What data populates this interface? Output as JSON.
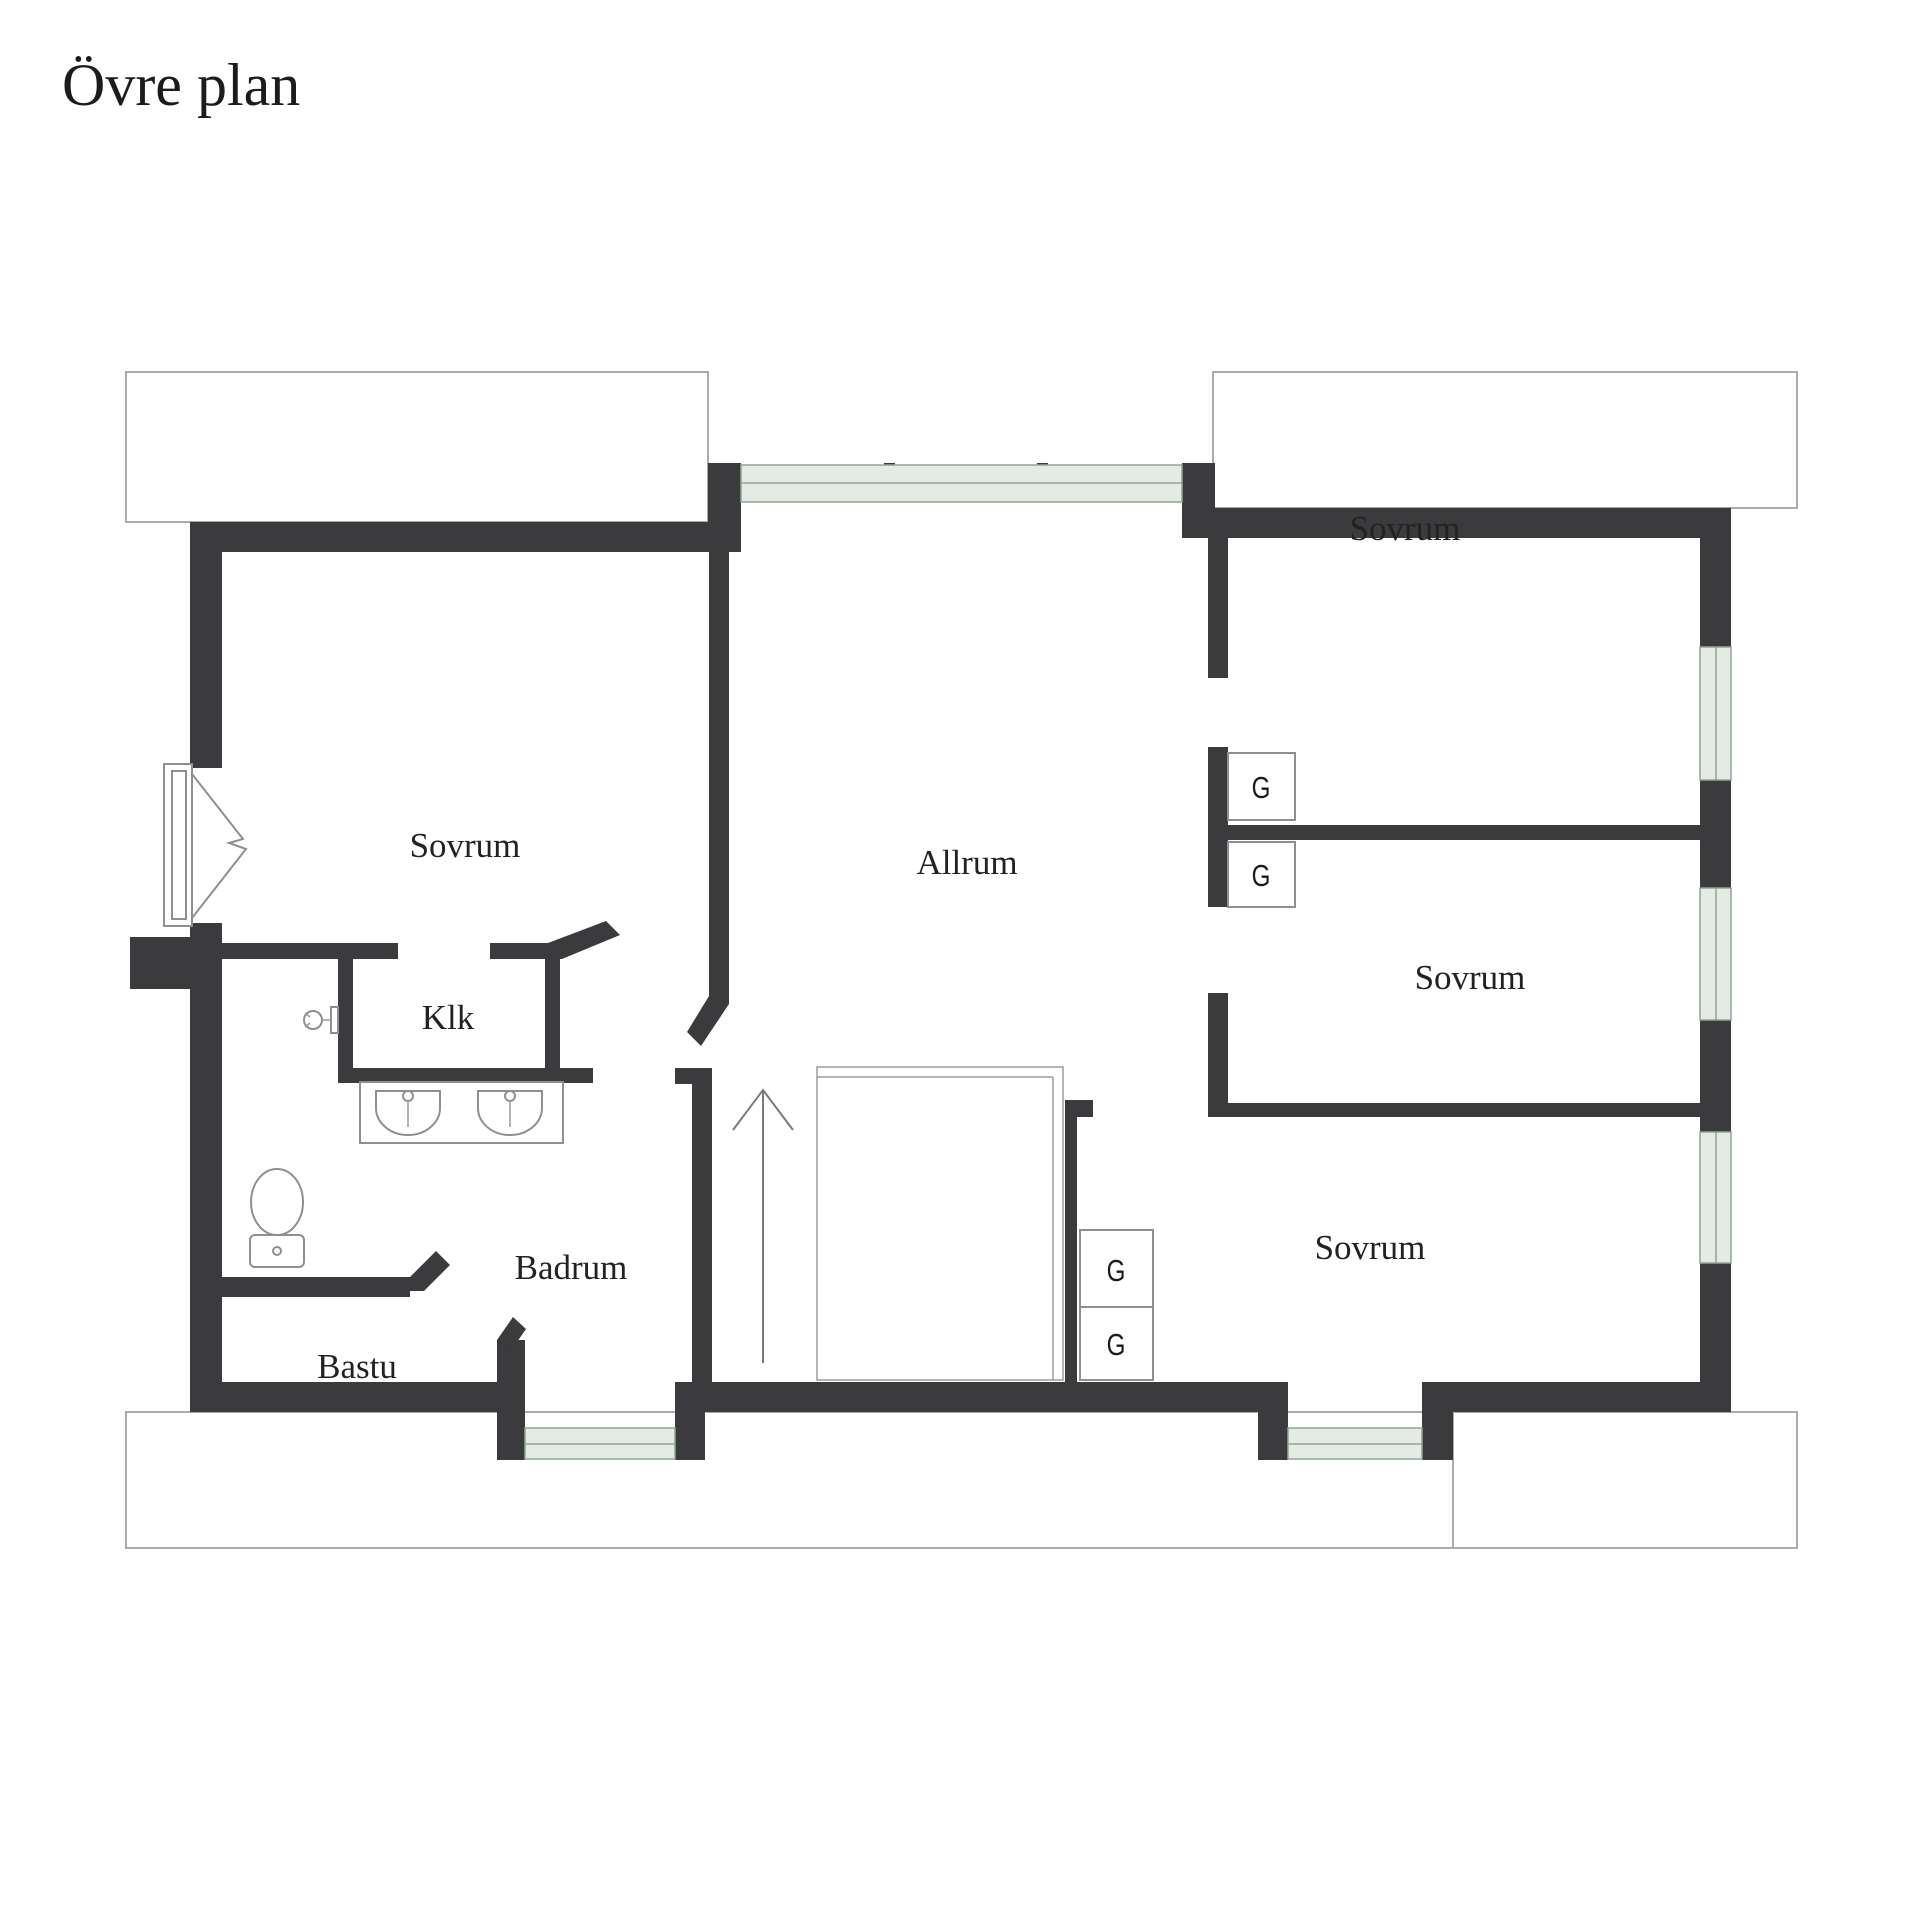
{
  "title": "Övre plan",
  "plan": {
    "rooms": [
      {
        "id": "sovrum-top-left",
        "label": "Sovrum"
      },
      {
        "id": "sovrum-top-right",
        "label": "Sovrum"
      },
      {
        "id": "sovrum-middle-right",
        "label": "Sovrum"
      },
      {
        "id": "sovrum-bottom-right",
        "label": "Sovrum"
      },
      {
        "id": "allrum",
        "label": "Allrum"
      },
      {
        "id": "klk",
        "label": "Klk"
      },
      {
        "id": "badrum",
        "label": "Badrum"
      },
      {
        "id": "bastu",
        "label": "Bastu"
      }
    ],
    "wardrobes": [
      {
        "id": "g-top-right-upper",
        "label": "G"
      },
      {
        "id": "g-top-right-lower",
        "label": "G"
      },
      {
        "id": "g-bottom-right-upper",
        "label": "G"
      },
      {
        "id": "g-bottom-right-lower",
        "label": "G"
      }
    ],
    "colors": {
      "wall": "#3b3b3d",
      "window_glass": "#e4ebe4",
      "roof_outline": "#ababab",
      "text": "#222222",
      "background": "#ffffff"
    }
  }
}
